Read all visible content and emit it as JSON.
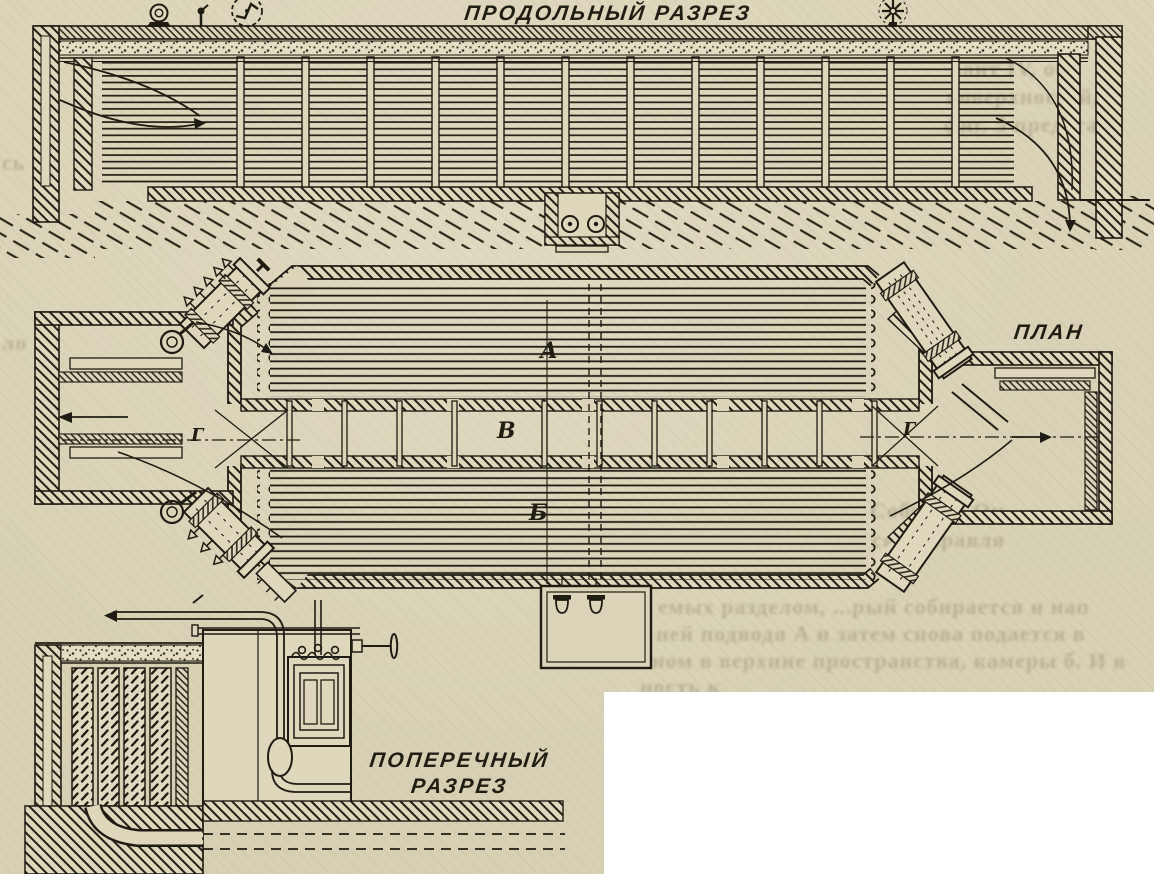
{
  "page": {
    "type": "scanned technical drawing (furnace/dryer sections)",
    "language": "ru",
    "titles": {
      "longitudinal": "ПРОДОЛЬНЫЙ РАЗРЕЗ",
      "plan": "ПЛАН",
      "cross_line1": "ПОПЕРЕЧНЫЙ",
      "cross_line2": "РАЗРЕЗ"
    },
    "part_labels": {
      "upper_coil": "А",
      "center_channel": "В",
      "lower_coil": "Б",
      "left_end": "Г",
      "right_end": "Г"
    },
    "ghost_text": [
      {
        "text": "вант IV, обр"
      },
      {
        "text": "поверхностей, с"
      },
      {
        "text": "фиг. 5 представл"
      },
      {
        "text": "Собрать. Он"
      },
      {
        "text": "ся направля"
      },
      {
        "text": "емых разделом, ...рый собирается и нап"
      },
      {
        "text": "ней подводя А и затем снова подается в"
      },
      {
        "text": "ном в верхние пространства, камеры б. И в"
      },
      {
        "text": "ность к"
      },
      {
        "text": "сь"
      },
      {
        "text": "ло"
      }
    ],
    "colors": {
      "paper": "#dbd4b8",
      "ink": "#1f1c13",
      "mask": "#ffffff",
      "ghost": "#8f8569"
    }
  }
}
